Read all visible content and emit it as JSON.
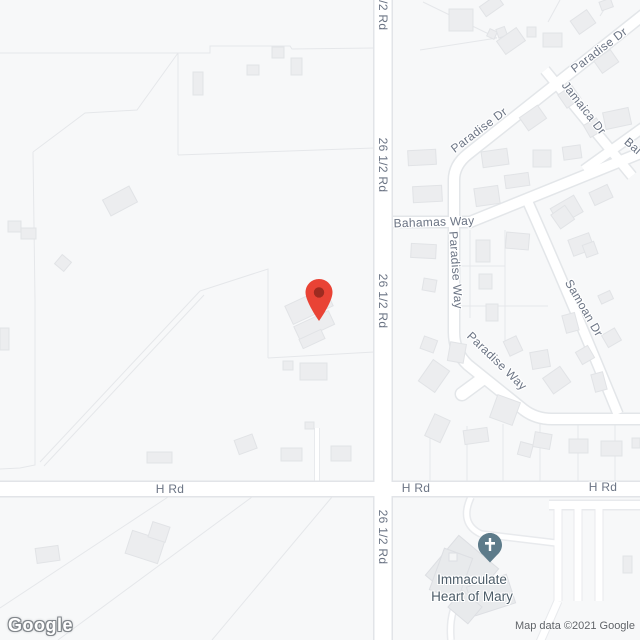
{
  "map_labels": {
    "r26": [
      "26 1/2 Rd",
      "26 1/2 Rd",
      "26 1/2 Rd",
      "26 1/2 Rd"
    ],
    "h_rd": [
      "H Rd",
      "H Rd",
      "H Rd"
    ],
    "paradise_dr": [
      "Paradise Dr",
      "Paradise Dr"
    ],
    "paradise_way": [
      "Paradise Way",
      "Paradise Way"
    ],
    "bahamas_way": "Bahamas Way",
    "jamaica_dr": "Jamaica Dr",
    "samoan_dr": "Samoan Dr",
    "bal_partial": "Bal"
  },
  "poi": {
    "name": "Immaculate Heart of Mary",
    "line1": "Immaculate",
    "line2": "Heart of Mary"
  },
  "marker": {
    "type": "red-map-pin",
    "fill": "#E94335",
    "hole": "#9E2B20"
  },
  "church_icon": {
    "type": "church-cross",
    "fill": "#5D7B8A"
  },
  "footer": {
    "logo": "Google",
    "attribution": "Map data ©2021 Google"
  }
}
